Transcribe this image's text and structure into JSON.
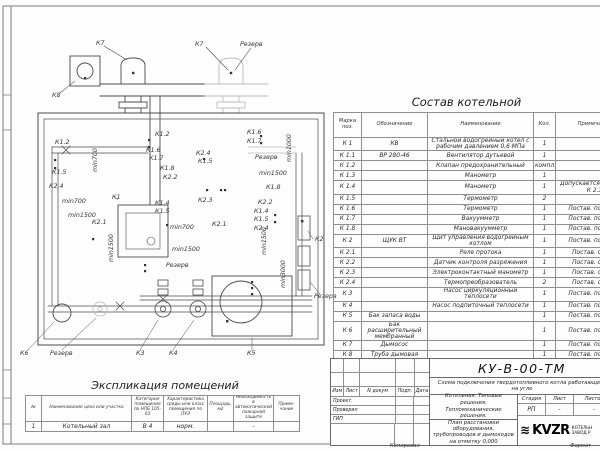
{
  "colors": {
    "line": "#4a4a4a",
    "light_line": "#bcbcbc",
    "paper": "#fdfdfd",
    "logo": "#000000"
  },
  "equipment_table": {
    "title": "Состав котельной",
    "headers": [
      "Марка поз.",
      "Обозначение",
      "Наименование",
      "Кол.",
      "Примечание"
    ],
    "rows": [
      [
        "К 1",
        "КВ",
        "Стальной водогрейный котел с рабочим давлением 0,6 МПа",
        "1",
        ""
      ],
      [
        "К 1.1",
        "ВР 280-46",
        "Вентилятор дутьевой",
        "1",
        ""
      ],
      [
        "К 1.2",
        "",
        "Клапан предохранительный",
        "компл.",
        ""
      ],
      [
        "К 1.3",
        "",
        "Манометр",
        "1",
        ""
      ],
      [
        "К 1.4",
        "",
        "Манометр",
        "1",
        "Допускается зам. поз. К 2.3"
      ],
      [
        "К 1.5",
        "",
        "Термометр",
        "2",
        ""
      ],
      [
        "К 1.6",
        "",
        "Термометр",
        "1",
        "Постав. по согла"
      ],
      [
        "К 1.7",
        "",
        "Вакуумметр",
        "1",
        "Постав. по согла"
      ],
      [
        "К 1.8",
        "",
        "Мановакуумметр",
        "1",
        "Постав. по согла"
      ],
      [
        "К 2",
        "ЩУК ВТ",
        "Щит управления водогрейным котлом",
        "1",
        "Постав. по согла"
      ],
      [
        "К 2.1",
        "",
        "Реле протока",
        "1",
        "Постав. с ЩУК"
      ],
      [
        "К 2.2",
        "",
        "Датчик контроля разряжения",
        "1",
        "Постав. с ЩУК"
      ],
      [
        "К 2.3",
        "",
        "Электроконтактный манометр",
        "1",
        "Постав. с ЩУК"
      ],
      [
        "К 2.4",
        "",
        "Термопреобразователь",
        "2",
        "Постав. с ЩУК"
      ],
      [
        "К 3",
        "",
        "Насос циркуляционный теплосети",
        "1",
        "Постав. по согла"
      ],
      [
        "К 4",
        "",
        "Насос подпиточный теплосети",
        "1",
        "Постав. по согла"
      ],
      [
        "К 5",
        "Бак запаса воды",
        "",
        "1",
        "Постав. по согла"
      ],
      [
        "К 6",
        "Бак расширительный мембранный",
        "",
        "1",
        "Постав. по согла"
      ],
      [
        "К 7",
        "Дымосос",
        "",
        "1",
        "Постав. по согла"
      ],
      [
        "К 8",
        "Труба дымовая",
        "",
        "1",
        "Постав. по согла"
      ]
    ]
  },
  "explication_table": {
    "title": "Экспликация помещений",
    "headers": [
      "№",
      "Наименование цеха или участка",
      "Категория помещения по НПБ 105-03",
      "Характеристика среды или класс помещения по ПУЭ",
      "Площадь, м2",
      "Необходимость в автоматической пожарной защите",
      "Приме- чание"
    ],
    "rows": [
      [
        "1",
        "Котельный зал",
        "В 4",
        "норм.",
        "",
        "-",
        ""
      ]
    ]
  },
  "title_block": {
    "doc_number": "КУ-В-00-ТМ",
    "scheme_title": "Схема подключения твердотопливного котла работающего на угле",
    "object_title": "Котельная. Типовые решения. Тепломеханические решения.",
    "drawing_title": "План расстановки оборудования, трубопроводов и дымоходов на отметку 0,000",
    "sign_header": [
      "Изм",
      "Лист",
      "N докум",
      "Подп.",
      "Дата"
    ],
    "sign_rows": [
      "Проект.",
      "Проверил",
      "ГИП"
    ],
    "stage_header": [
      "Стадия",
      "Лист",
      "Листов"
    ],
    "stage_values": [
      "РП",
      "-",
      "-"
    ],
    "logo_word": "KVZR",
    "logo_caption_1": "КОТЕЛЬН",
    "logo_caption_2": "ЗАВОД Р",
    "copied_label": "Копировал",
    "format_label": "Формат"
  },
  "plan": {
    "labels": [
      {
        "t": "К7",
        "x": 96,
        "y": 45
      },
      {
        "t": "К7",
        "x": 195,
        "y": 46
      },
      {
        "t": "Резерв",
        "x": 240,
        "y": 46
      },
      {
        "t": "К8",
        "x": 52,
        "y": 97
      },
      {
        "t": "К1.2",
        "x": 55,
        "y": 144
      },
      {
        "t": "min700",
        "x": 97,
        "y": 172,
        "r": -90
      },
      {
        "t": "К1.5",
        "x": 52,
        "y": 174
      },
      {
        "t": "К2.4",
        "x": 49,
        "y": 188
      },
      {
        "t": "min700",
        "x": 62,
        "y": 203
      },
      {
        "t": "min1500",
        "x": 68,
        "y": 217
      },
      {
        "t": "К2.1",
        "x": 92,
        "y": 224
      },
      {
        "t": "К1",
        "x": 112,
        "y": 199
      },
      {
        "t": "К1.2",
        "x": 155,
        "y": 136
      },
      {
        "t": "К1.6",
        "x": 146,
        "y": 152
      },
      {
        "t": "К1.7",
        "x": 149,
        "y": 160
      },
      {
        "t": "К1.8",
        "x": 160,
        "y": 170
      },
      {
        "t": "К2.2",
        "x": 163,
        "y": 179
      },
      {
        "t": "К2.4",
        "x": 196,
        "y": 155
      },
      {
        "t": "К1.5",
        "x": 198,
        "y": 163
      },
      {
        "t": "К1.4",
        "x": 155,
        "y": 205
      },
      {
        "t": "К1.5",
        "x": 155,
        "y": 213
      },
      {
        "t": "К2.3",
        "x": 198,
        "y": 202
      },
      {
        "t": "min700",
        "x": 170,
        "y": 229
      },
      {
        "t": "К2.1",
        "x": 212,
        "y": 226
      },
      {
        "t": "min1500",
        "x": 172,
        "y": 251
      },
      {
        "t": "Резерв",
        "x": 166,
        "y": 267
      },
      {
        "t": "min1500",
        "x": 113,
        "y": 262,
        "r": -90
      },
      {
        "t": "К1.6",
        "x": 247,
        "y": 134
      },
      {
        "t": "К1.7",
        "x": 247,
        "y": 143
      },
      {
        "t": "Резерв",
        "x": 255,
        "y": 159
      },
      {
        "t": "min1000",
        "x": 291,
        "y": 162,
        "r": -90
      },
      {
        "t": "min1500",
        "x": 259,
        "y": 175
      },
      {
        "t": "К1.8",
        "x": 266,
        "y": 189
      },
      {
        "t": "К2.2",
        "x": 258,
        "y": 204
      },
      {
        "t": "К1.4",
        "x": 254,
        "y": 213
      },
      {
        "t": "К1.5",
        "x": 254,
        "y": 221
      },
      {
        "t": "К2.4",
        "x": 254,
        "y": 230
      },
      {
        "t": "min1500",
        "x": 266,
        "y": 255,
        "r": -90
      },
      {
        "t": "min3000",
        "x": 285,
        "y": 288,
        "r": -90
      },
      {
        "t": "К2",
        "x": 315,
        "y": 241
      },
      {
        "t": "Резерв",
        "x": 314,
        "y": 298
      },
      {
        "t": "К6",
        "x": 20,
        "y": 355
      },
      {
        "t": "Резерв",
        "x": 50,
        "y": 355
      },
      {
        "t": "К3",
        "x": 136,
        "y": 355
      },
      {
        "t": "К4",
        "x": 169,
        "y": 355
      },
      {
        "t": "К5",
        "x": 247,
        "y": 355
      }
    ]
  }
}
